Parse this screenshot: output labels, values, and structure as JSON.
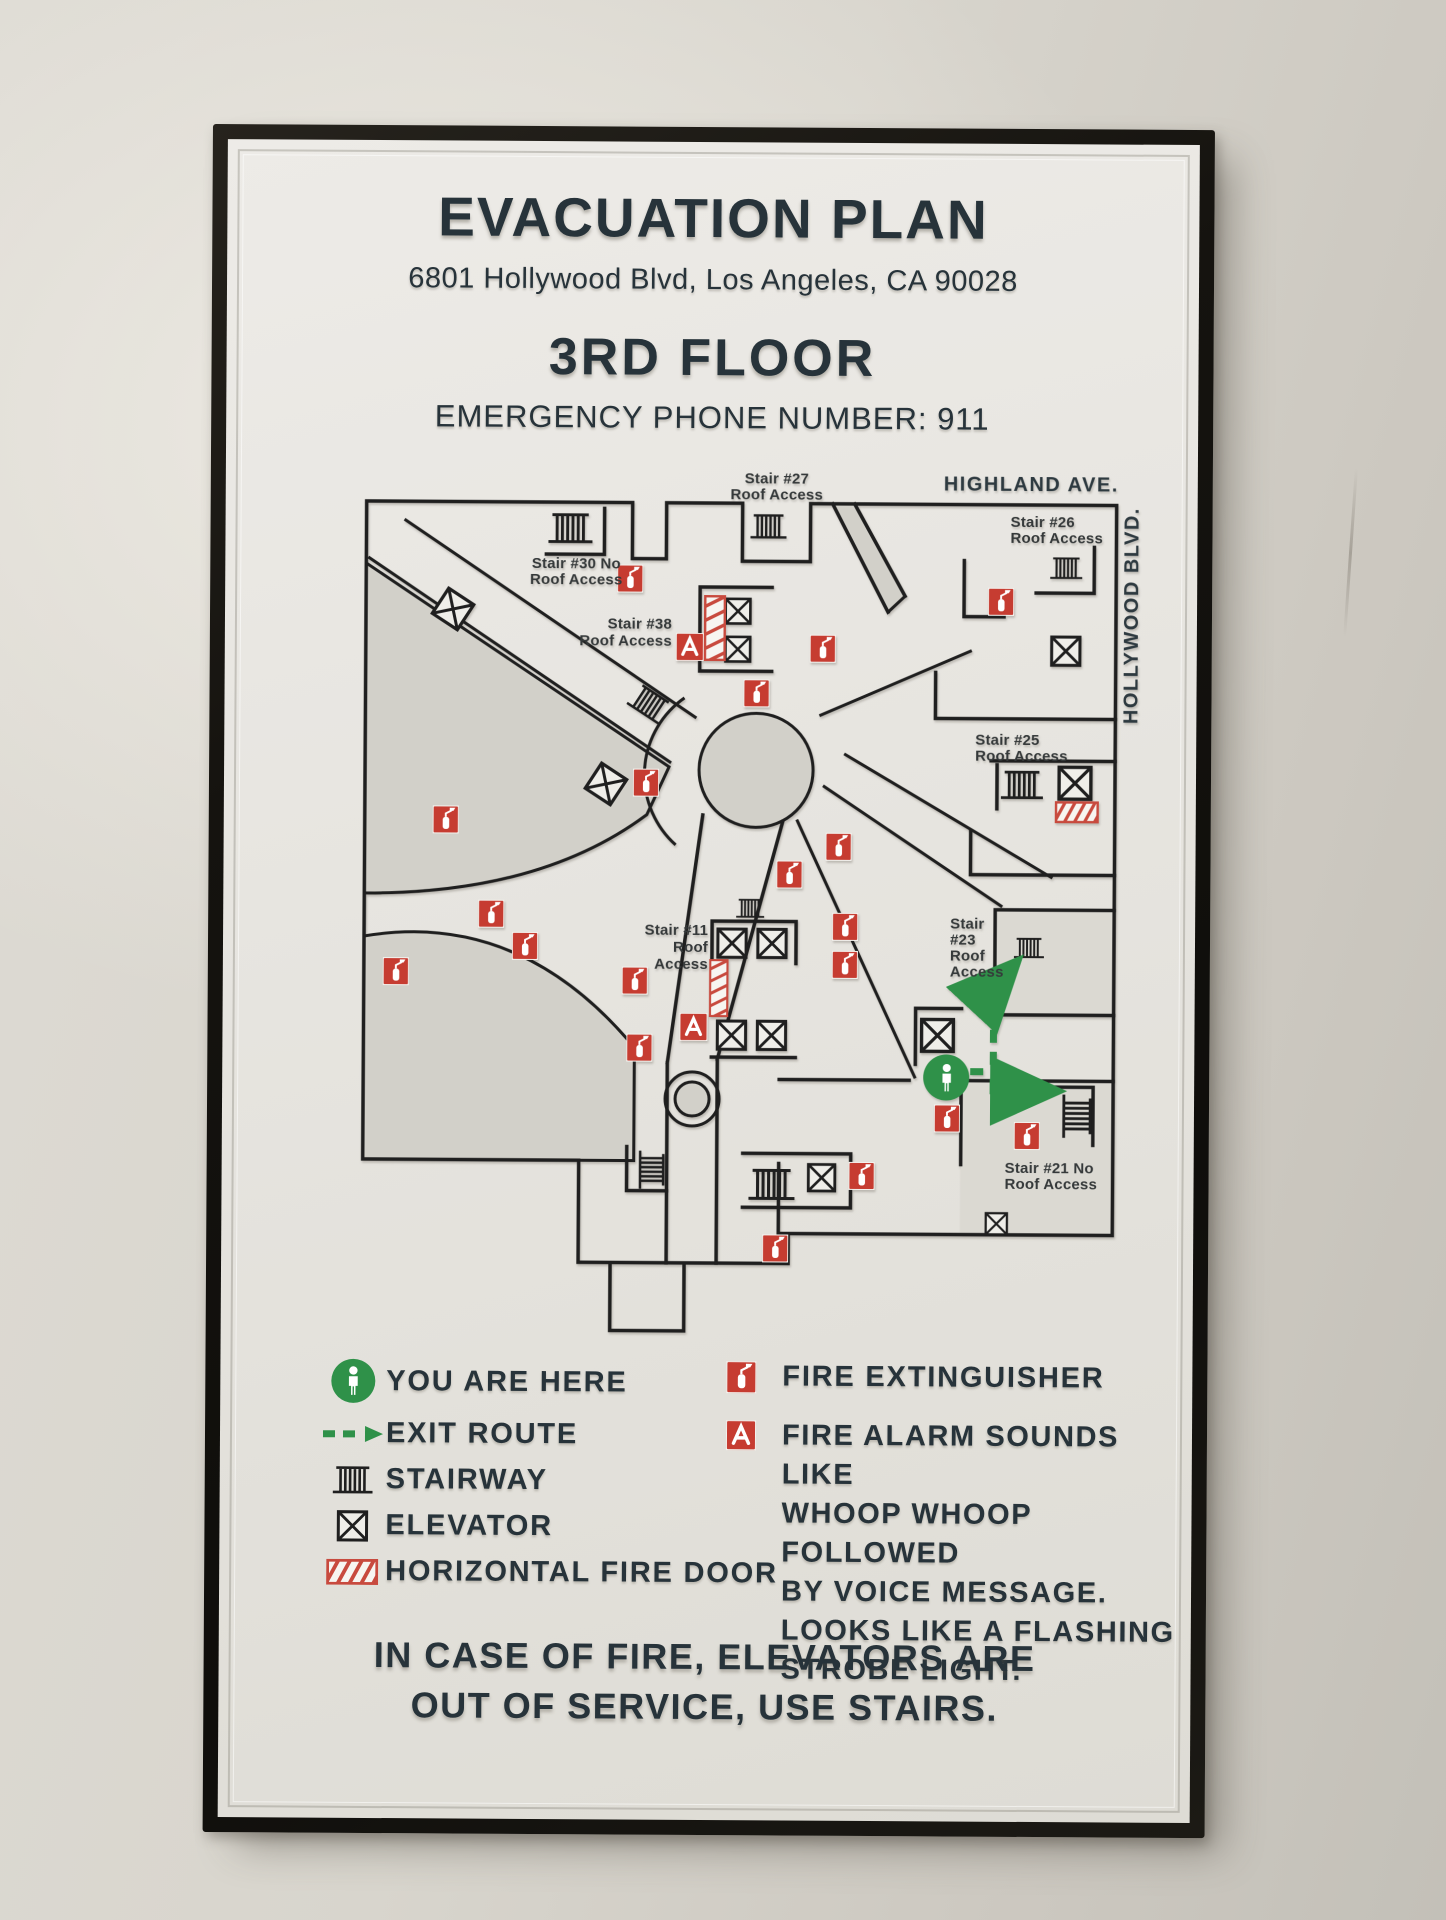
{
  "sign": {
    "title": "EVACUATION PLAN",
    "address": "6801 Hollywood Blvd, Los Angeles, CA 90028",
    "floor": "3RD FLOOR",
    "emergency": "EMERGENCY PHONE NUMBER: 911",
    "footer_lines": [
      "IN CASE OF FIRE, ELEVATORS ARE",
      "OUT OF SERVICE, USE STAIRS."
    ]
  },
  "map": {
    "streets": {
      "top": "HIGHLAND AVE.",
      "right": "HOLLYWOOD BLVD."
    },
    "labels": {
      "stair27": [
        "Stair #27",
        "Roof Access"
      ],
      "stair30": [
        "Stair #30 No",
        "Roof Access"
      ],
      "stair26": [
        "Stair #26",
        "Roof Access"
      ],
      "stair38": [
        "Stair #38",
        "Roof Access"
      ],
      "stair25": [
        "Stair #25",
        "Roof Access"
      ],
      "stair11": [
        "Stair #11",
        "Roof",
        "Access"
      ],
      "stair23": [
        "Stair",
        "#23",
        "Roof",
        "Access"
      ],
      "stair21": [
        "Stair #21 No",
        "Roof Access"
      ]
    }
  },
  "legend": {
    "you_are_here": "YOU ARE HERE",
    "exit_route": "EXIT ROUTE",
    "stairway": "STAIRWAY",
    "elevator": "ELEVATOR",
    "fire_door": "HORIZONTAL FIRE DOOR",
    "fire_extinguisher": "FIRE EXTINGUISHER",
    "fire_alarm_lines": [
      "FIRE ALARM SOUNDS LIKE",
      "WHOOP WHOOP FOLLOWED",
      "BY VOICE MESSAGE.",
      "LOOKS LIKE A FLASHING",
      "STROBE LIGHT."
    ]
  },
  "icons": {
    "you_are_here": "person-in-green-circle",
    "exit_route": "green-dashed-arrow",
    "stairway": "rail-bars",
    "elevator": "box-with-x",
    "fire_door": "red-striped-bar",
    "fire_extinguisher": "red-box-extinguisher",
    "fire_alarm": "red-box-letter-a"
  },
  "colors": {
    "red": "#c63c31",
    "green": "#2f9149",
    "ink": "#27333a",
    "frame": "#15130f"
  }
}
